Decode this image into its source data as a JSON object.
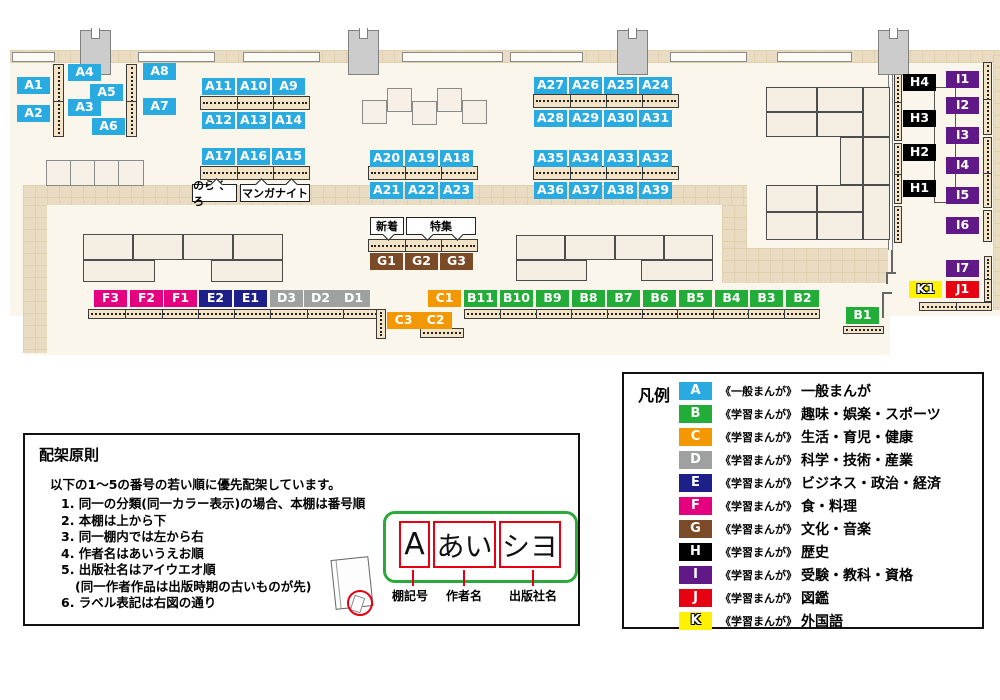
{
  "map": {
    "category_colors": {
      "A": "#29abe2",
      "B": "#22ac38",
      "C": "#f39800",
      "D": "#9fa0a0",
      "E": "#1d2088",
      "F": "#e4007f",
      "G": "#7b4b28",
      "H": "#000000",
      "I": "#601986",
      "J": "#e60012",
      "K": "#fff100"
    },
    "shelf_labels": [
      {
        "id": "A1",
        "x": 17,
        "y": 77
      },
      {
        "id": "A2",
        "x": 17,
        "y": 105
      },
      {
        "id": "A4",
        "x": 68,
        "y": 64
      },
      {
        "id": "A5",
        "x": 90,
        "y": 84
      },
      {
        "id": "A3",
        "x": 68,
        "y": 99
      },
      {
        "id": "A6",
        "x": 92,
        "y": 118
      },
      {
        "id": "A8",
        "x": 143,
        "y": 63
      },
      {
        "id": "A7",
        "x": 143,
        "y": 98
      },
      {
        "id": "A11",
        "x": 202,
        "y": 78
      },
      {
        "id": "A10",
        "x": 237,
        "y": 78
      },
      {
        "id": "A9",
        "x": 272,
        "y": 78
      },
      {
        "id": "A12",
        "x": 202,
        "y": 112
      },
      {
        "id": "A13",
        "x": 237,
        "y": 112
      },
      {
        "id": "A14",
        "x": 272,
        "y": 112
      },
      {
        "id": "A17",
        "x": 202,
        "y": 148
      },
      {
        "id": "A16",
        "x": 237,
        "y": 148
      },
      {
        "id": "A15",
        "x": 272,
        "y": 148
      },
      {
        "id": "A20",
        "x": 370,
        "y": 150
      },
      {
        "id": "A19",
        "x": 405,
        "y": 150
      },
      {
        "id": "A18",
        "x": 440,
        "y": 150
      },
      {
        "id": "A21",
        "x": 370,
        "y": 182
      },
      {
        "id": "A22",
        "x": 405,
        "y": 182
      },
      {
        "id": "A23",
        "x": 440,
        "y": 182
      },
      {
        "id": "A27",
        "x": 534,
        "y": 77
      },
      {
        "id": "A26",
        "x": 569,
        "y": 77
      },
      {
        "id": "A25",
        "x": 604,
        "y": 77
      },
      {
        "id": "A24",
        "x": 639,
        "y": 77
      },
      {
        "id": "A28",
        "x": 534,
        "y": 110
      },
      {
        "id": "A29",
        "x": 569,
        "y": 110
      },
      {
        "id": "A30",
        "x": 604,
        "y": 110
      },
      {
        "id": "A31",
        "x": 639,
        "y": 110
      },
      {
        "id": "A35",
        "x": 534,
        "y": 150
      },
      {
        "id": "A34",
        "x": 569,
        "y": 150
      },
      {
        "id": "A33",
        "x": 604,
        "y": 150
      },
      {
        "id": "A32",
        "x": 639,
        "y": 150
      },
      {
        "id": "A36",
        "x": 534,
        "y": 182
      },
      {
        "id": "A37",
        "x": 569,
        "y": 182
      },
      {
        "id": "A38",
        "x": 604,
        "y": 182
      },
      {
        "id": "A39",
        "x": 639,
        "y": 182
      },
      {
        "id": "G1",
        "x": 370,
        "y": 253
      },
      {
        "id": "G2",
        "x": 405,
        "y": 253
      },
      {
        "id": "G3",
        "x": 440,
        "y": 253
      },
      {
        "id": "F3",
        "x": 94,
        "y": 290
      },
      {
        "id": "F2",
        "x": 130,
        "y": 290
      },
      {
        "id": "F1",
        "x": 164,
        "y": 290
      },
      {
        "id": "E2",
        "x": 199,
        "y": 290
      },
      {
        "id": "E1",
        "x": 234,
        "y": 290
      },
      {
        "id": "D3",
        "x": 270,
        "y": 290
      },
      {
        "id": "D2",
        "x": 304,
        "y": 290
      },
      {
        "id": "D1",
        "x": 337,
        "y": 290
      },
      {
        "id": "C1",
        "x": 428,
        "y": 290
      },
      {
        "id": "C3",
        "x": 387,
        "y": 312
      },
      {
        "id": "C2",
        "x": 419,
        "y": 312
      },
      {
        "id": "B11",
        "x": 464,
        "y": 290
      },
      {
        "id": "B10",
        "x": 500,
        "y": 290
      },
      {
        "id": "B9",
        "x": 536,
        "y": 290
      },
      {
        "id": "B8",
        "x": 572,
        "y": 290
      },
      {
        "id": "B7",
        "x": 607,
        "y": 290
      },
      {
        "id": "B6",
        "x": 643,
        "y": 290
      },
      {
        "id": "B5",
        "x": 679,
        "y": 290
      },
      {
        "id": "B4",
        "x": 715,
        "y": 290
      },
      {
        "id": "B3",
        "x": 750,
        "y": 290
      },
      {
        "id": "B2",
        "x": 786,
        "y": 290
      },
      {
        "id": "B1",
        "x": 846,
        "y": 307
      },
      {
        "id": "H4",
        "x": 903,
        "y": 74
      },
      {
        "id": "H3",
        "x": 903,
        "y": 110
      },
      {
        "id": "H2",
        "x": 903,
        "y": 144
      },
      {
        "id": "H1",
        "x": 903,
        "y": 180
      },
      {
        "id": "I1",
        "x": 946,
        "y": 71
      },
      {
        "id": "I2",
        "x": 946,
        "y": 97
      },
      {
        "id": "I3",
        "x": 946,
        "y": 127
      },
      {
        "id": "I4",
        "x": 946,
        "y": 157
      },
      {
        "id": "I5",
        "x": 946,
        "y": 187
      },
      {
        "id": "I6",
        "x": 946,
        "y": 217
      },
      {
        "id": "I7",
        "x": 946,
        "y": 260
      },
      {
        "id": "K1",
        "x": 909,
        "y": 281
      },
      {
        "id": "J1",
        "x": 946,
        "y": 281
      }
    ],
    "annotations": [
      {
        "text": "のらくろ",
        "x": 192,
        "y": 184,
        "w": 45,
        "notch": "top"
      },
      {
        "text": "マンガナイト",
        "x": 240,
        "y": 184,
        "w": 70,
        "notch": "top"
      },
      {
        "text": "新着",
        "x": 370,
        "y": 217,
        "w": 34,
        "notch": "bottom"
      },
      {
        "text": "特集",
        "x": 406,
        "y": 217,
        "w": 70,
        "notch": "bottom"
      }
    ]
  },
  "legend": {
    "title": "凡例",
    "items": [
      {
        "code": "A",
        "color": "#29abe2",
        "prefix": "《一般まんが》",
        "label": "一般まんが"
      },
      {
        "code": "B",
        "color": "#22ac38",
        "prefix": "《学習まんが》",
        "label": "趣味・娯楽・スポーツ"
      },
      {
        "code": "C",
        "color": "#f39800",
        "prefix": "《学習まんが》",
        "label": "生活・育児・健康"
      },
      {
        "code": "D",
        "color": "#9fa0a0",
        "prefix": "《学習まんが》",
        "label": "科学・技術・産業"
      },
      {
        "code": "E",
        "color": "#1d2088",
        "prefix": "《学習まんが》",
        "label": "ビジネス・政治・経済"
      },
      {
        "code": "F",
        "color": "#e4007f",
        "prefix": "《学習まんが》",
        "label": "食・料理"
      },
      {
        "code": "G",
        "color": "#7b4b28",
        "prefix": "《学習まんが》",
        "label": "文化・音楽"
      },
      {
        "code": "H",
        "color": "#000000",
        "prefix": "《学習まんが》",
        "label": "歴史"
      },
      {
        "code": "I",
        "color": "#601986",
        "prefix": "《学習まんが》",
        "label": "受験・教科・資格"
      },
      {
        "code": "J",
        "color": "#e60012",
        "prefix": "《学習まんが》",
        "label": "図鑑"
      },
      {
        "code": "K",
        "color": "#fff100",
        "prefix": "《学習まんが》",
        "label": "外国語"
      }
    ]
  },
  "principles": {
    "title": "配架原則",
    "intro": "以下の1〜5の番号の若い順に優先配架しています。",
    "items": [
      "1. 同一の分類(同一カラー表示)の場合、本棚は番号順",
      "2. 本棚は上から下",
      "3. 同一棚内では左から右",
      "4. 作者名はあいうえお順",
      "5. 出版社名はアイウエオ順",
      "(同一作者作品は出版時期の古いものが先)",
      "6. ラベル表記は右図の通り"
    ],
    "label_example": {
      "shelf_code": "A",
      "author": "あい",
      "publisher": "シヨ",
      "captions": [
        "棚記号",
        "作者名",
        "出版社名"
      ]
    }
  }
}
